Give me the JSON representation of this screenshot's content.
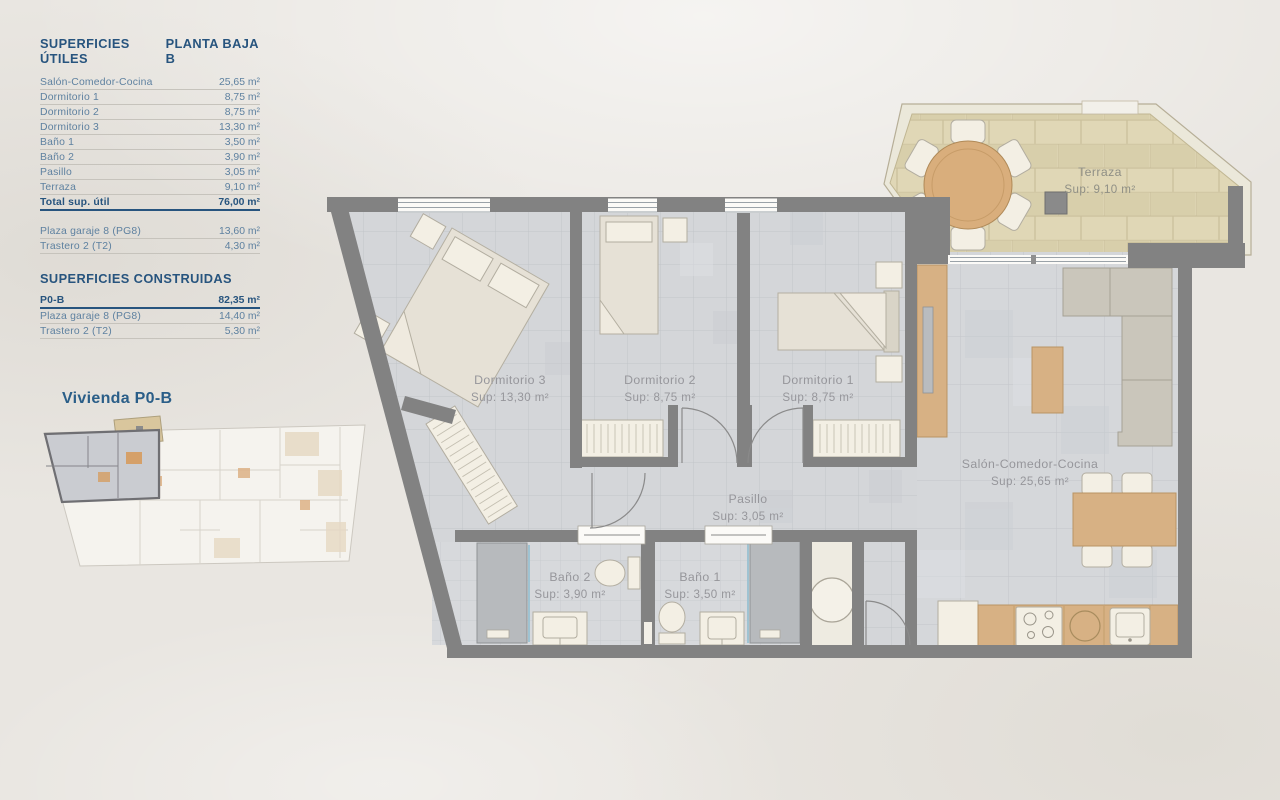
{
  "panel": {
    "title_utiles": "SUPERFICIES ÚTILES",
    "floor": "PLANTA BAJA B",
    "utiles_rows": [
      {
        "label": "Salón-Comedor-Cocina",
        "value": "25,65 m²"
      },
      {
        "label": "Dormitorio 1",
        "value": "8,75 m²"
      },
      {
        "label": "Dormitorio 2",
        "value": "8,75 m²"
      },
      {
        "label": "Dormitorio 3",
        "value": "13,30 m²"
      },
      {
        "label": "Baño 1",
        "value": "3,50 m²"
      },
      {
        "label": "Baño 2",
        "value": "3,90 m²"
      },
      {
        "label": "Pasillo",
        "value": "3,05 m²"
      },
      {
        "label": "Terraza",
        "value": "9,10 m²"
      }
    ],
    "total_row": {
      "label": "Total sup. útil",
      "value": "76,00 m²"
    },
    "anexos_rows": [
      {
        "label": "Plaza garaje 8 (PG8)",
        "value": "13,60 m²"
      },
      {
        "label": "Trastero 2 (T2)",
        "value": "4,30 m²"
      }
    ],
    "title_construidas": "SUPERFICIES CONSTRUIDAS",
    "construidas_main": {
      "label": "P0-B",
      "value": "82,35 m²"
    },
    "construidas_rows": [
      {
        "label": "Plaza garaje 8 (PG8)",
        "value": "14,40 m²"
      },
      {
        "label": "Trastero 2 (T2)",
        "value": "5,30 m²"
      }
    ]
  },
  "key_plan": {
    "label": "Vivienda P0-B"
  },
  "plan": {
    "rooms": [
      {
        "name": "Terraza",
        "sup": "Sup: 9,10 m²"
      },
      {
        "name": "Dormitorio 3",
        "sup": "Sup: 13,30 m²"
      },
      {
        "name": "Dormitorio 2",
        "sup": "Sup: 8,75 m²"
      },
      {
        "name": "Dormitorio 1",
        "sup": "Sup: 8,75 m²"
      },
      {
        "name": "Pasillo",
        "sup": "Sup: 3,05 m²"
      },
      {
        "name": "Baño 2",
        "sup": "Sup: 3,90 m²"
      },
      {
        "name": "Baño 1",
        "sup": "Sup: 3,50 m²"
      },
      {
        "name": "Salón-Comedor-Cocina",
        "sup": "Sup: 25,65 m²"
      }
    ]
  },
  "colors": {
    "accent_blue": "#27547e",
    "wall_gray": "#828282",
    "terrace_tan": "#dcd3b1",
    "floor_gray": "#d4d6d9"
  }
}
